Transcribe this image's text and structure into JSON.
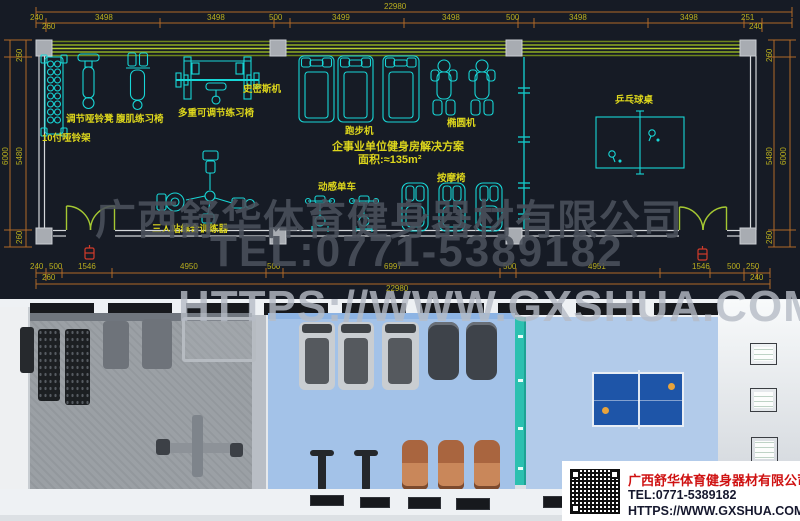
{
  "watermark": {
    "company": "广西舒华体育健身器材有限公司",
    "tel": "TEL:0771-5389182",
    "url": "HTTPS://WWW.GXSHUA.COM"
  },
  "plan": {
    "solution_title": "企事业单位健身房解决方案",
    "area": "面积:≈135m²",
    "equipment_labels": {
      "dumbbell_rack": "10付哑铃架",
      "adjustable_dumbbell_bench": "调节哑铃凳",
      "ab_chair": "腹肌练习椅",
      "multi_adjustable_chair": "多重可调节练习椅",
      "smith_machine": "史密斯机",
      "treadmill": "跑步机",
      "elliptical": "椭圆机",
      "ping_pong_table": "乒乓球桌",
      "spin_bike": "动感单车",
      "massage_chair": "按摩椅",
      "three_person_trainer": "三人站综合训练器"
    },
    "dimensions": {
      "total_top": "22980",
      "top_segments": [
        "240",
        "3498",
        "3498",
        "500",
        "3499",
        "3498",
        "500",
        "3498",
        "3498",
        "251"
      ],
      "top_left_sub": "260",
      "top_right_sub": "240",
      "bottom_segments": [
        "240",
        "500",
        "1546",
        "4950",
        "500",
        "6997",
        "500",
        "4951",
        "1546",
        "500",
        "250"
      ],
      "bottom_left_sub": "260",
      "bottom_right_sub": "240",
      "total_bottom": "22980",
      "left_outer": "6000",
      "left_inner": "5480",
      "left_top": "260",
      "left_bottom": "260",
      "right_outer": "6000",
      "right_inner": "5480",
      "right_top": "260",
      "right_bottom": "260"
    }
  },
  "render_card": {
    "company": "广西舒华体育健身器材有限公司",
    "tel": "TEL:0771-5389182",
    "url": "HTTPS://WWW.GXSHUA.COM"
  },
  "colors": {
    "plan_background": "#161b25",
    "equipment_cyan": "#18d6d6",
    "label_yellow": "#ddd61c",
    "dimension_orange": "#b06a28",
    "door_green": "#a5c832",
    "wall_olive": "#8fae24",
    "exit_red": "#d23b2a",
    "teal_partition": "#2cc0b0",
    "floor_blue": "#a3c2e8",
    "floor_gray": "#9ba0a5",
    "table_blue": "#1e55a8",
    "brand_red": "#cf1212"
  }
}
